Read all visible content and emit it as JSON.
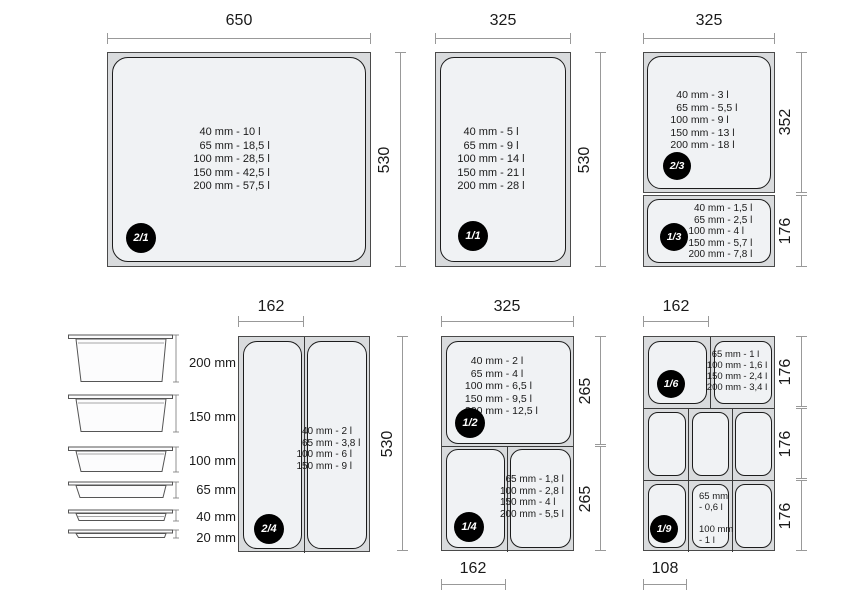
{
  "colors": {
    "panel_fill": "#d9dbdd",
    "cell_fill": "#f0f2f4",
    "dimension_line": "#999999",
    "badge_bg": "#000000",
    "badge_fg": "#ffffff",
    "text": "#1a1a1a"
  },
  "panels": {
    "gn21": {
      "badge": "2/1",
      "top_dim": "650",
      "right_dim": "530",
      "capacities": [
        "40 mm - 10 l",
        "65 mm - 18,5 l",
        "100 mm - 28,5 l",
        "150 mm - 42,5 l",
        "200 mm - 57,5 l"
      ]
    },
    "gn11": {
      "badge": "1/1",
      "top_dim": "325",
      "right_dim": "530",
      "capacities": [
        "40 mm - 5 l",
        "65 mm - 9 l",
        "100 mm - 14 l",
        "150 mm - 21 l",
        "200 mm - 28 l"
      ]
    },
    "gn23": {
      "badge": "2/3",
      "top_dim": "325",
      "right_dim": "352",
      "capacities": [
        "40 mm - 3 l",
        "65 mm - 5,5 l",
        "100 mm - 9 l",
        "150 mm - 13 l",
        "200 mm - 18 l"
      ]
    },
    "gn13": {
      "badge": "1/3",
      "right_dim": "176",
      "capacities": [
        "40 mm - 1,5 l",
        "65 mm - 2,5 l",
        "100 mm - 4 l",
        "150 mm - 5,7 l",
        "200 mm - 7,8 l"
      ]
    },
    "gn24": {
      "badge": "2/4",
      "top_dim": "162",
      "right_dim": "530",
      "capacities": [
        "40 mm - 2 l",
        "65 mm - 3,8 l",
        "100 mm - 6 l",
        "150 mm - 9 l"
      ]
    },
    "gn12": {
      "badge": "1/2",
      "top_dim": "325",
      "right_dim": "265",
      "capacities": [
        "40 mm - 2 l",
        "65 mm - 4 l",
        "100 mm - 6,5 l",
        "150 mm - 9,5 l",
        "200 mm - 12,5 l"
      ]
    },
    "gn14": {
      "badge": "1/4",
      "bottom_dim": "162",
      "right_dim": "265",
      "capacities": [
        "65 mm - 1,8 l",
        "100 mm - 2,8 l",
        "150 mm - 4 l",
        "200 mm - 5,5 l"
      ]
    },
    "gn16": {
      "badge": "1/6",
      "top_dim": "162",
      "right_dim": "176",
      "capacities": [
        "65 mm - 1 l",
        "100 mm - 1,6 l",
        "150 mm - 2,4 l",
        "200 mm - 3,4 l"
      ]
    },
    "middle_row": {
      "right_dim": "176"
    },
    "gn19": {
      "badge": "1/9",
      "bottom_dim": "108",
      "right_dim": "176",
      "lines": [
        "65 mm",
        "- 0,6 l",
        "",
        "100 mm",
        "- 1 l"
      ]
    }
  },
  "depth_stack": {
    "labels": [
      "200 mm",
      "150 mm",
      "100 mm",
      "65 mm",
      "40 mm",
      "20 mm"
    ]
  }
}
